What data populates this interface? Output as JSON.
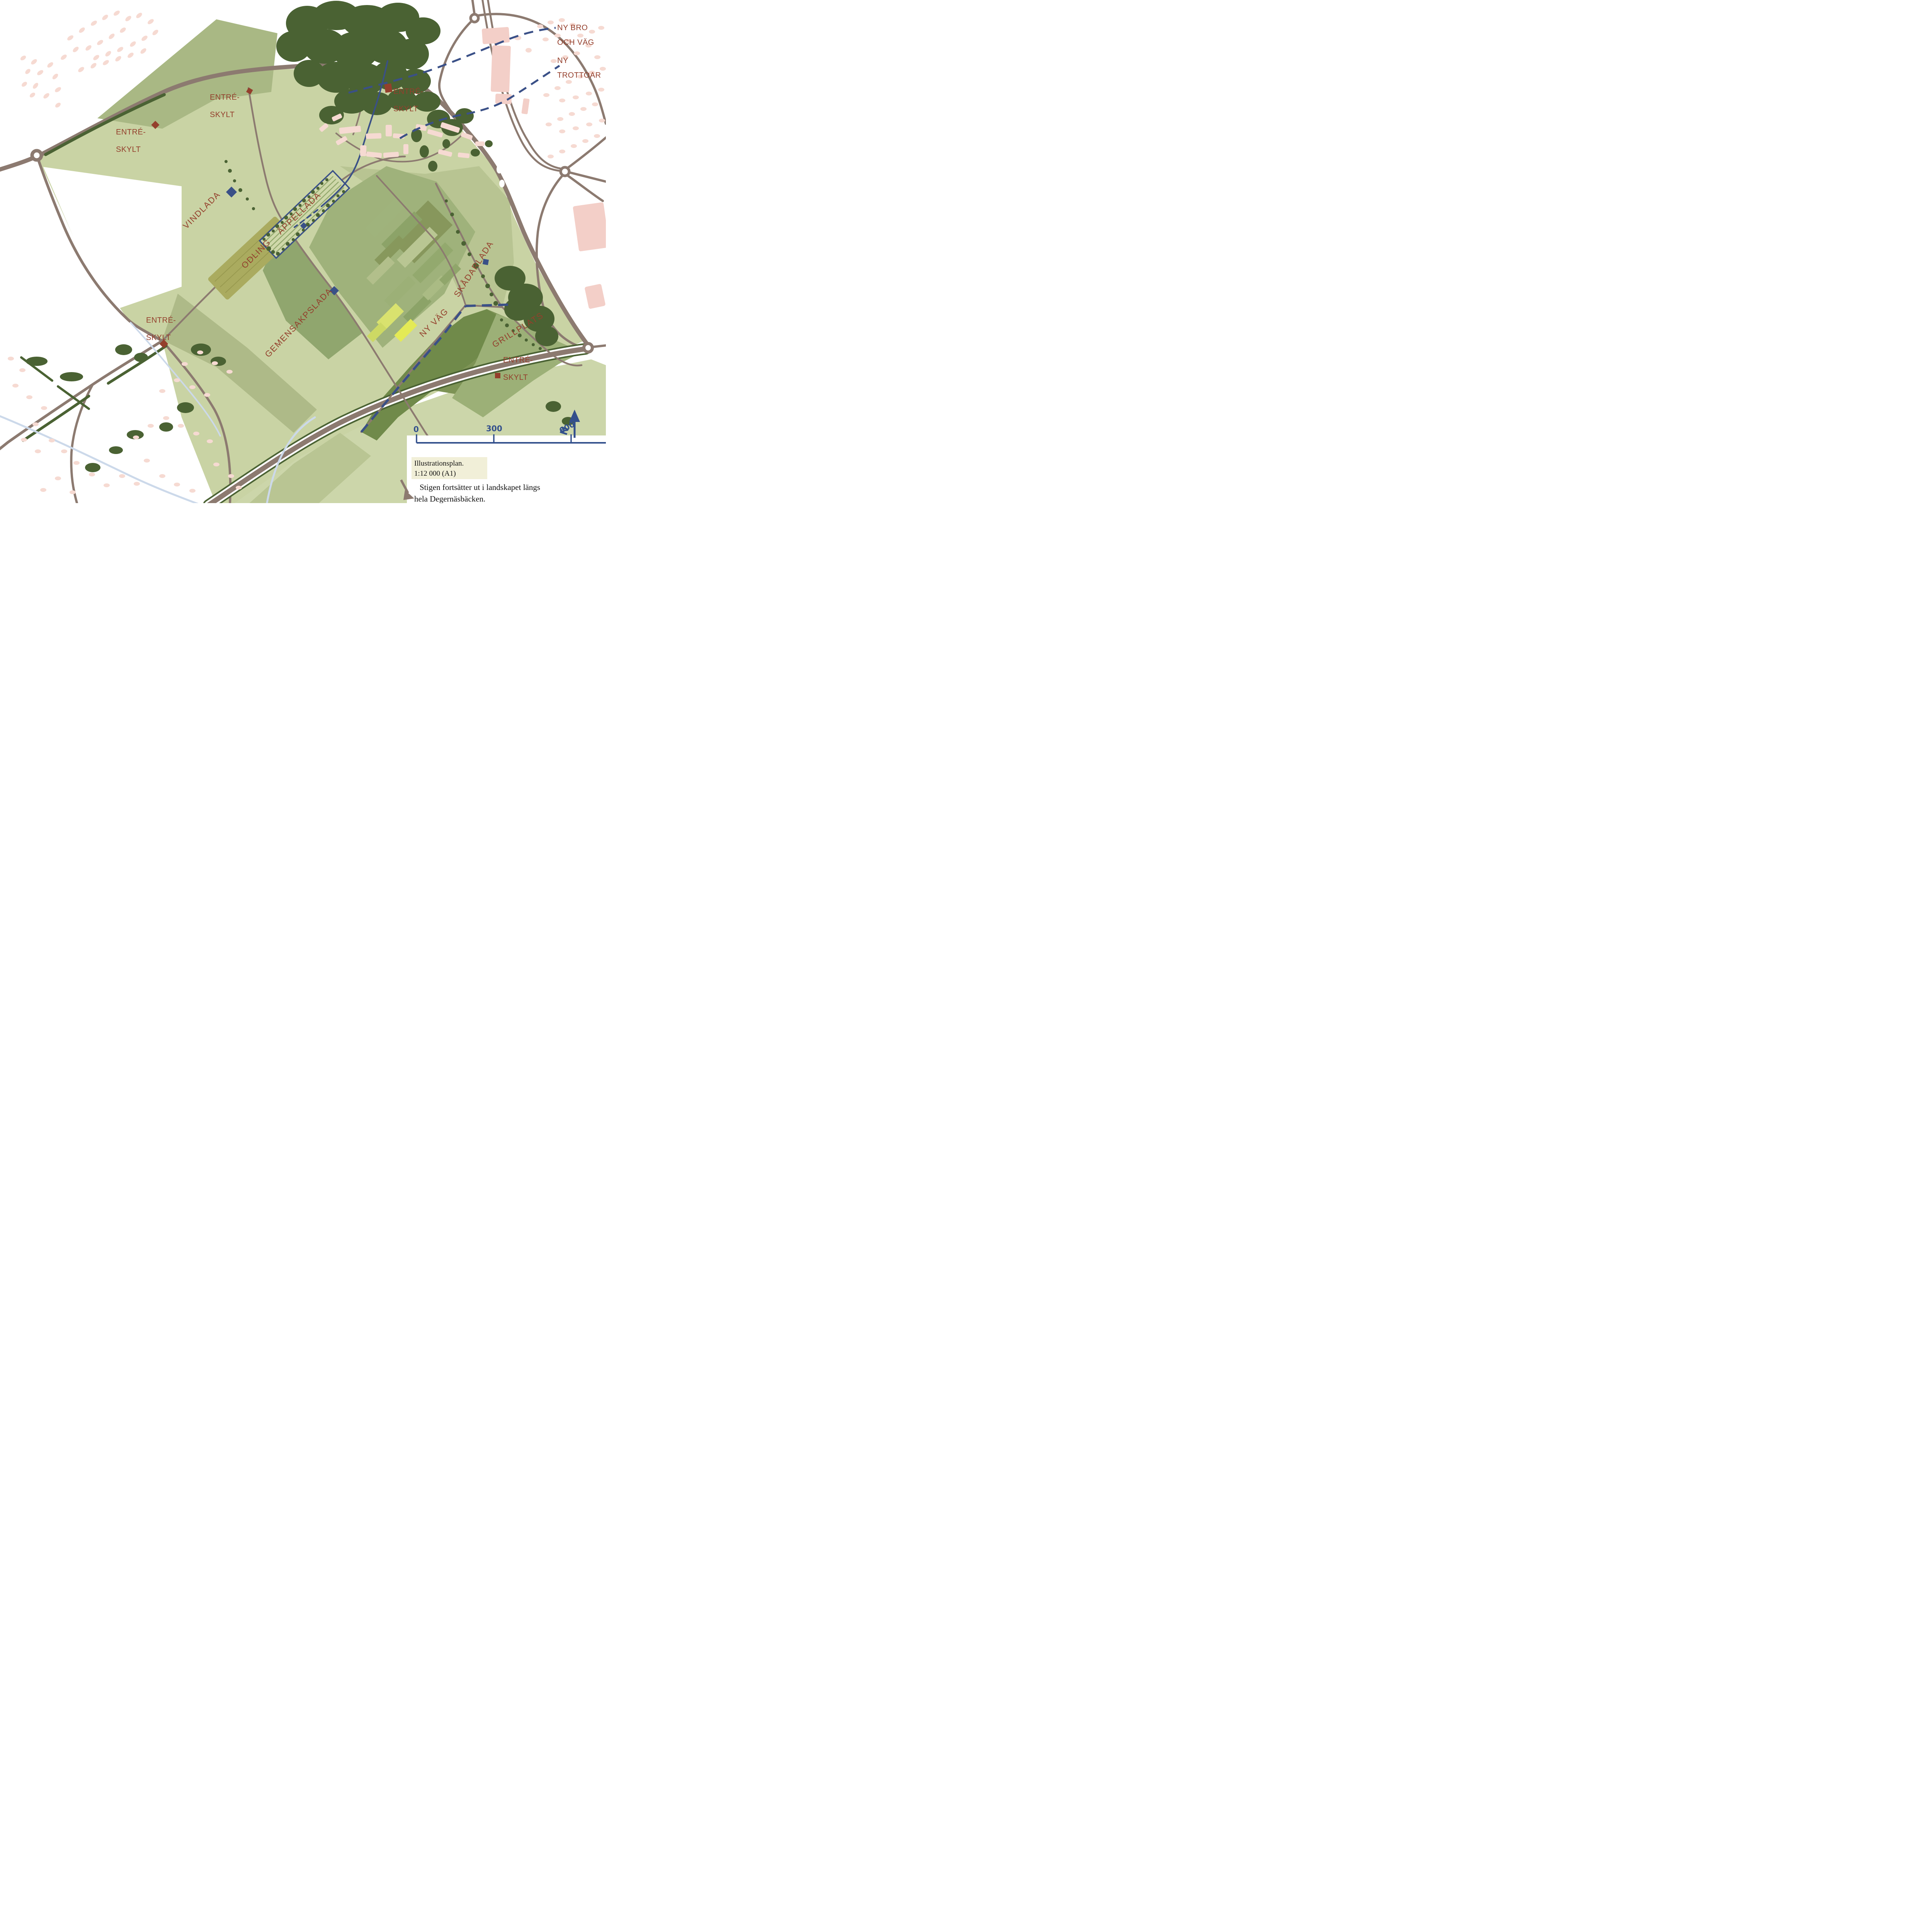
{
  "map": {
    "type": "illustration-plan",
    "labels": {
      "ny_bro_line1": "NY BRO",
      "ny_bro_line2": "OCH VÄG",
      "ny_trottoar_line1": "NY",
      "ny_trottoar_line2": "TROTTOAR",
      "entre_line1": "ENTRÉ-",
      "entre_line2": "SKYLT",
      "vindlada": "VINDLADA",
      "appellada": "ÄPPELLADA",
      "odling": "ODLING",
      "gemensakpslada": "GEMENSAKPSLADA",
      "skadarlada": "SKÅDARLADA",
      "ny_vag": "NY VÄG",
      "grillplats": "GRILLPLATS"
    },
    "markers": {
      "entre_sign_count": 5,
      "building_marker_count": 4
    },
    "legend": {
      "title": "Illustrationsplan.",
      "scale": "1:12 000 (A1)"
    },
    "scale_bar": {
      "tick0": "0",
      "tick300": "300",
      "tick600": "600"
    },
    "north_arrow": {
      "label": "N"
    },
    "note": {
      "line1": "Stigen fortsätter ut i landskapet längs",
      "line2": "hela Degernäsbäcken."
    },
    "colors": {
      "label_red": "#943f2c",
      "marker_blue": "#3a5087",
      "road_taupe": "#8c7a70",
      "forest_green": "#4a6233",
      "field_light": "#c9d3a4",
      "field_medium": "#a9b884",
      "field_dark": "#708a4a",
      "odling_olive": "#aaab5f",
      "building_pink": "#f6dad2",
      "stream_pale_blue": "#ccd9ea",
      "legend_cream": "#f1efd8"
    }
  }
}
